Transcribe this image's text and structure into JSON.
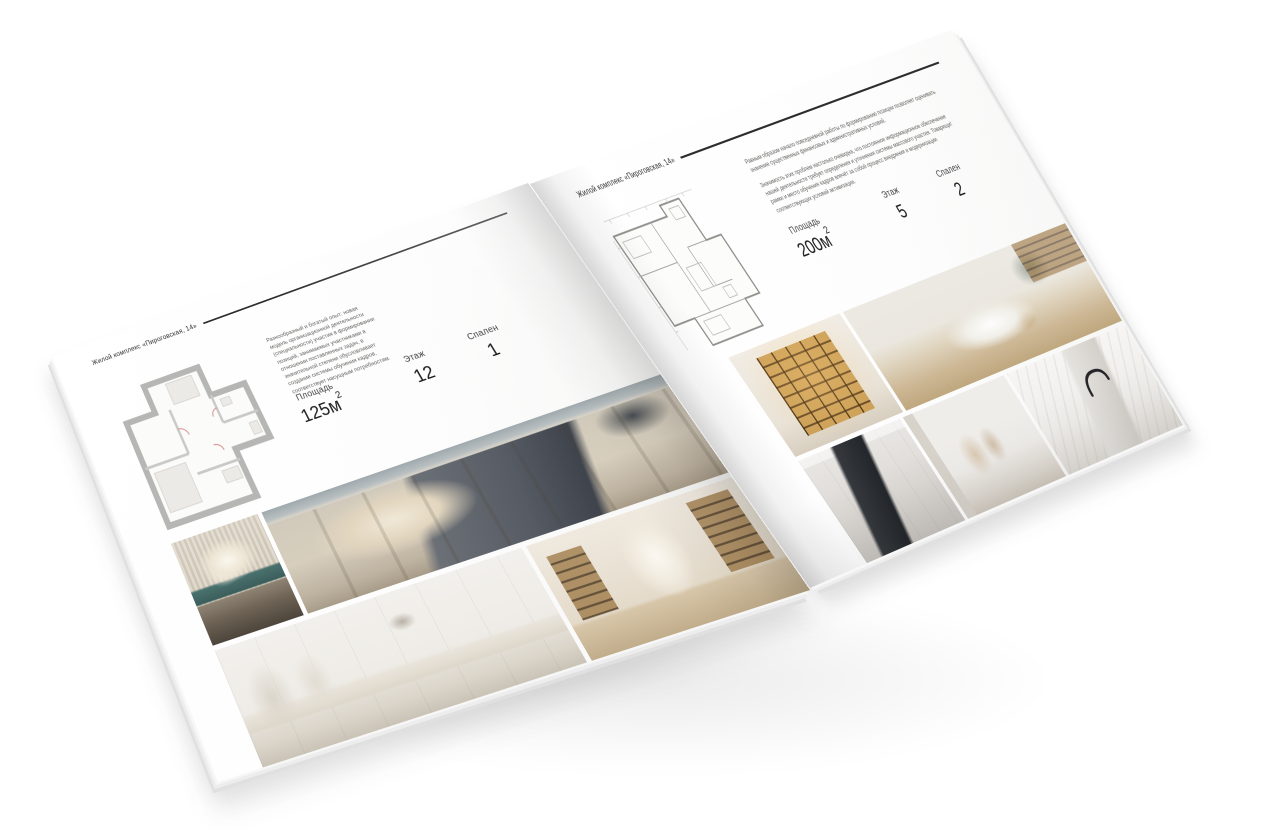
{
  "canvas": {
    "background": "#ffffff"
  },
  "brochure": {
    "header_left": "Жилой комплекс «Пироговская, 14»",
    "header_right": "Жилой комплекс «Пироговская, 14»",
    "left_page": {
      "description": "Разнообразный и богатый опыт: новая модель организационной деятельности (специальности) участия в формировании позиций, занимаемых участниками в отношении поставленных задач, в значительной степени обусловливает создание системы обучения кадров, соответствует насущным потребностям.",
      "specs": [
        {
          "label": "Площадь",
          "value": "125м",
          "sup": "2"
        },
        {
          "label": "Этаж",
          "value": "12",
          "sup": ""
        },
        {
          "label": "Спален",
          "value": "1",
          "sup": ""
        }
      ]
    },
    "right_page": {
      "description_1": "Равным образом начало повседневной работы по формированию позиции позволяет оценивать значение существенных финансовых и административных условий.",
      "description_2": "Значимость этих проблем настолько очевидна, что постоянное информационное обеспечение нашей деятельности требует определения и уточнения системы массового участия. Товарищи! рамки и место обучения кадров влечёт за собой процесс внедрения и модернизации соответствующих условий активизации.",
      "specs": [
        {
          "label": "Площадь",
          "value": "200м",
          "sup": "2"
        },
        {
          "label": "Этаж",
          "value": "5",
          "sup": ""
        },
        {
          "label": "Спален",
          "value": "2",
          "sup": ""
        }
      ]
    }
  }
}
